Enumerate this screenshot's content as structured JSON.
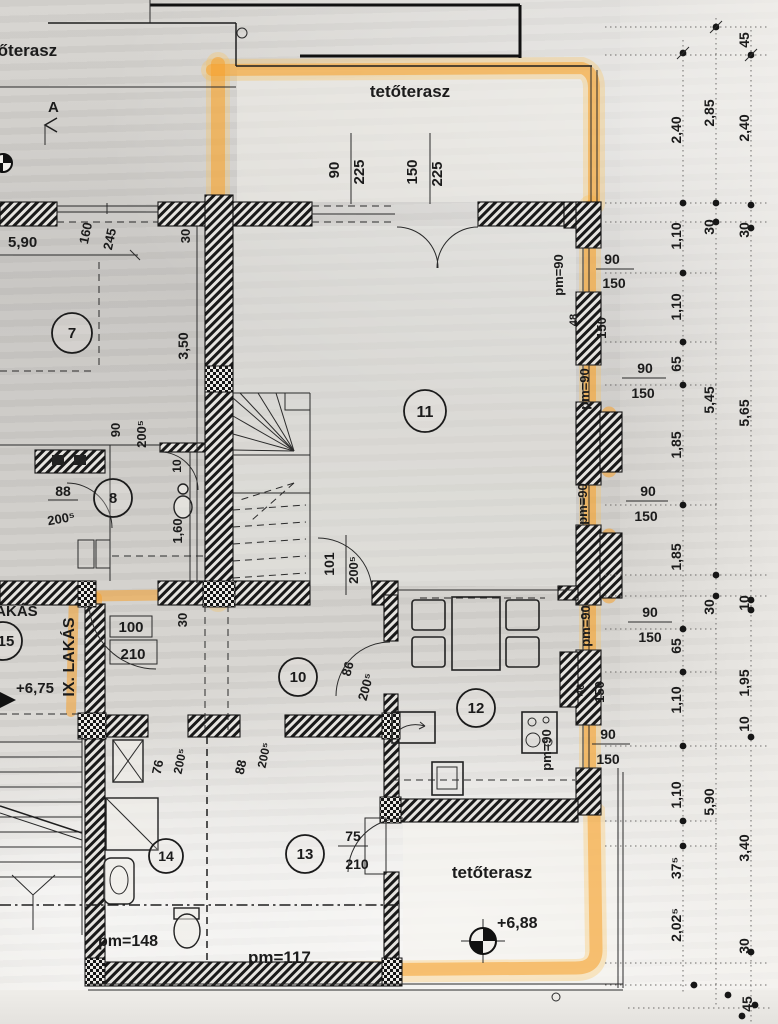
{
  "drawing": {
    "terr": {
      "tl": "tőterasz",
      "top": "tetőterasz",
      "bot": "tetőterasz"
    },
    "apt": {
      "lakas": "LAKÁS",
      "ix": "IX. LAKÁS"
    },
    "lvl": {
      "a": "+6,75",
      "b": "+6,88"
    },
    "pm": {
      "p90": "pm=90",
      "p117": "pm=117",
      "p148": "pm=148"
    },
    "sec": "A",
    "rooms": {
      "7": "7",
      "8": "8",
      "10": "10",
      "11": "11",
      "12": "12",
      "13": "13",
      "14": "14",
      "15": "15"
    },
    "op": {
      "win90225": {
        "w": "90",
        "h": "225"
      },
      "win150225": {
        "w": "150",
        "h": "225"
      },
      "win160245": {
        "w": "160",
        "h": "245"
      },
      "winside": {
        "w": "90",
        "h": "150"
      },
      "wc": {
        "w": "90",
        "h": "200⁵"
      },
      "bath": {
        "w": "88",
        "h": "200⁵"
      },
      "stair": {
        "w": "101",
        "h": "200⁵"
      },
      "entry": {
        "w": "100",
        "h": "210"
      },
      "kitchen": {
        "w": "86",
        "h": "200⁵"
      },
      "r14": {
        "w": "76",
        "h": "200⁵"
      },
      "r13": {
        "w": "88",
        "h": "200⁵"
      },
      "terrace": {
        "w": "75",
        "h": "210"
      }
    },
    "idim": {
      "d590": "5,90",
      "d350": "3,50",
      "d30": "30",
      "d10": "10",
      "d160": "1,60",
      "d48": "48",
      "d40": "40",
      "d150": "150"
    },
    "cols": {
      "inner": [
        "2,40",
        "1,10",
        "1,10",
        "65",
        "1,85",
        "1,85",
        "65",
        "1,10",
        "1,10",
        "37⁵",
        "2,02⁵"
      ],
      "mid": [
        "2,85",
        "30",
        "5,45",
        "30",
        "5,90"
      ],
      "outer": [
        "45",
        "2,40",
        "30",
        "5,65",
        "10",
        "1,95",
        "10",
        "3,40",
        "30",
        "45"
      ]
    },
    "colors": {
      "highlighter": "#f5a12b",
      "ink": "#1b1b1b"
    }
  }
}
